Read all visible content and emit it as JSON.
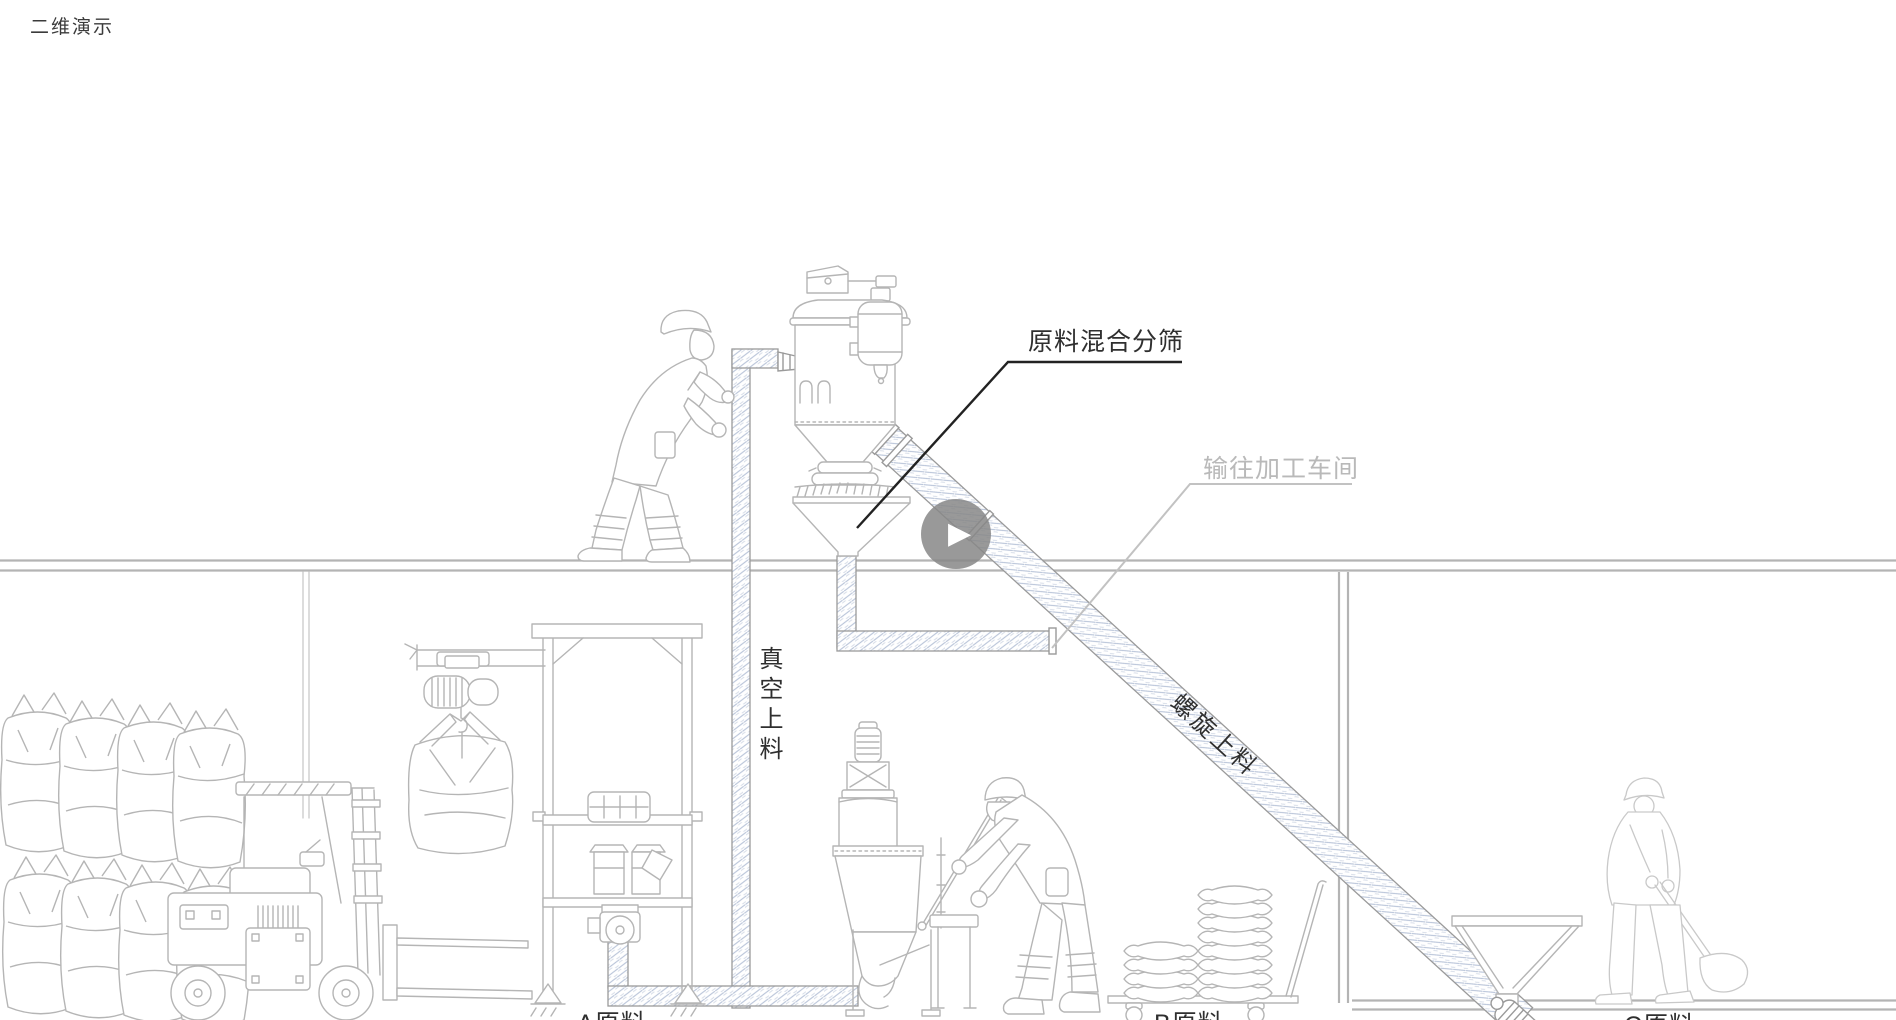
{
  "page": {
    "title": "二维演示"
  },
  "annotations": {
    "mix_sieve": "原料混合分筛",
    "to_workshop": "输往加工车间",
    "vacuum_feed": "真空上料",
    "screw_feed": "螺旋上料",
    "material_a": "A原料",
    "material_b": "B原料",
    "material_c": "C原料"
  },
  "player": {
    "play_icon": "▶"
  },
  "colors": {
    "bg": "#ffffff",
    "title": "#3b3b3b",
    "line": "#b5b5b5",
    "line2": "#9a9a9a",
    "faint": "#c9c9c9",
    "hatch1": "#b7c3d8",
    "hatch2": "#d3dae6",
    "floor": "#b4b4b4",
    "callout1": "#222222",
    "callout2": "#c2c2c2",
    "label1": "#2f2f2f",
    "label2": "#b9b9b9",
    "playbg": "rgba(135,135,135,0.85)",
    "playfg": "#ffffff"
  }
}
